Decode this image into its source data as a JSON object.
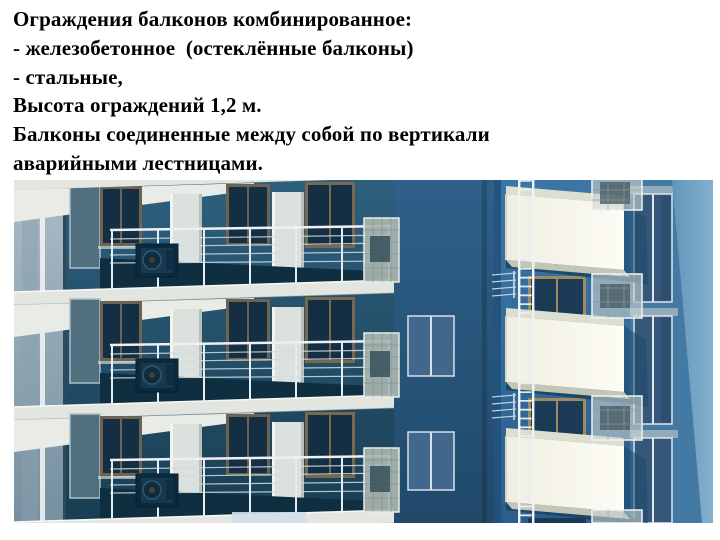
{
  "slide": {
    "lines": [
      "Ограждения балконов комбинированное:",
      "- железобетонное  (остеклённые балконы)",
      "- стальные,",
      "Высота ограждений 1,2 м.",
      "Балконы соединенные между собой по вертикали",
      "аварийными лестницами."
    ]
  },
  "figure": {
    "alt": "3D render of apartment building facade: open balconies with combined reinforced-concrete and steel railings, glazed balconies at left, white box balconies connected vertically by emergency ladders, wall-mounted air conditioners",
    "palette": {
      "page_bg": "#ffffff",
      "text": "#000000",
      "left_wall": "#24536e",
      "corner_wall": "#2a5a7f",
      "front_wall": "#346c9c",
      "side_wall": "#6096ba",
      "slab": "#e3e6e0",
      "balcony_box": "#f8f6ea",
      "glass": "#142f43",
      "railing": "#edf1f4",
      "ladder": "#eef3f6"
    }
  }
}
